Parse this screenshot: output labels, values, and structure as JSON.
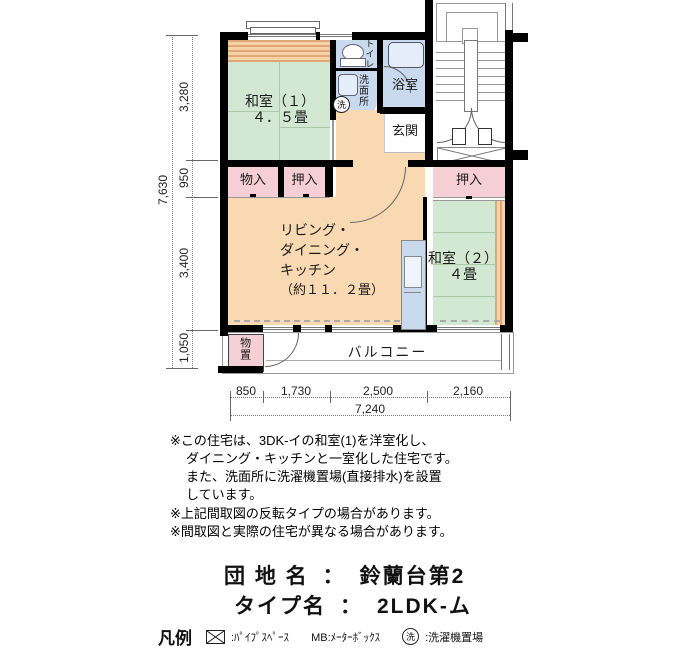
{
  "plan": {
    "rooms": {
      "washitsu1": {
        "name": "和室（１）",
        "size": "４．５畳"
      },
      "washitsu2": {
        "name": "和室（２）",
        "size": "４畳"
      },
      "ldk": {
        "line1": "リビング・",
        "line2": "ダイニング・",
        "line3": "キッチン",
        "line4": "（約１１．２畳）"
      },
      "toilet": "トイレ",
      "washroom": "洗面所",
      "wash_symbol": "洗",
      "bath": "浴室",
      "genkan": "玄関",
      "monoire": "物入",
      "oshiire1": "押入",
      "oshiire2": "押入",
      "monooki": "物置",
      "balcony": "バルコニー"
    },
    "dimensions": {
      "left_total": "7,630",
      "left_segments": [
        "3,280",
        "950",
        "3,400",
        "1,050"
      ],
      "bottom_segments": [
        "850",
        "1,730",
        "2,500",
        "2,160"
      ],
      "bottom_total": "7,240"
    }
  },
  "notes": {
    "line1": "※この住宅は、3DK-イの和室(1)を洋室化し、",
    "line2": "ダイニング・キッチンと一室化した住宅です。",
    "line3": "また、洗面所に洗濯機置場(直接排水)を設置",
    "line4": "しています。",
    "line5": "※上記間取図の反転タイプの場合があります。",
    "line6": "※間取図と実際の住宅が異なる場合があります。"
  },
  "info": {
    "estate_label": "団 地 名",
    "separator": "：",
    "estate_value": "鈴蘭台第2",
    "type_label": "タイプ名",
    "type_value": "2LDK-ム"
  },
  "legend": {
    "title": "凡例",
    "pipe_label": ":ﾊﾟｲﾌﾟｽﾍﾟｰｽ",
    "mb_label": "MB:ﾒｰﾀｰﾎﾞｯｸｽ",
    "wash_symbol": "洗",
    "wash_label": ":洗濯機置場"
  },
  "colors": {
    "wall": "#000000",
    "tatami_green": "#d3e8d3",
    "ldk_peach": "#f8d9b2",
    "closet_pink": "#f6cfd6",
    "water_blue": "#c9d9ee"
  }
}
